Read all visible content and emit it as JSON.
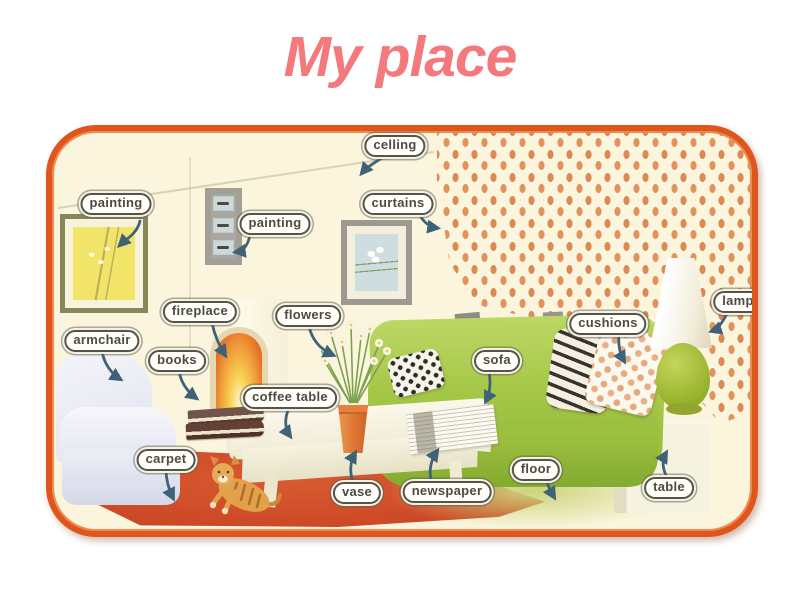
{
  "title": "My place",
  "colors": {
    "title_color": "#f4797c",
    "frame_border": "#e0551c",
    "frame_border_light": "#f08b4f",
    "room_bg": "#faf5dc",
    "arrow": "#3f6278",
    "label_text": "#4b4b44",
    "label_bg": "#fffef8",
    "curtain_dot": "#e2935c",
    "sofa_green": "#a3c544",
    "carpet_red": "#cf4b28",
    "lamp_green": "#9cb531"
  },
  "labels": [
    {
      "id": "ceiling",
      "text": "celling"
    },
    {
      "id": "painting-left",
      "text": "painting"
    },
    {
      "id": "painting-middle",
      "text": "painting"
    },
    {
      "id": "curtains",
      "text": "curtains"
    },
    {
      "id": "fireplace",
      "text": "fireplace"
    },
    {
      "id": "flowers",
      "text": "flowers"
    },
    {
      "id": "cushions",
      "text": "cushions"
    },
    {
      "id": "lamp",
      "text": "lamp"
    },
    {
      "id": "armchair",
      "text": "armchair"
    },
    {
      "id": "books",
      "text": "books"
    },
    {
      "id": "sofa",
      "text": "sofa"
    },
    {
      "id": "coffee-table",
      "text": "coffee table"
    },
    {
      "id": "carpet",
      "text": "carpet"
    },
    {
      "id": "floor",
      "text": "floor"
    },
    {
      "id": "vase",
      "text": "vase"
    },
    {
      "id": "newspaper",
      "text": "newspaper"
    },
    {
      "id": "table",
      "text": "table"
    }
  ]
}
